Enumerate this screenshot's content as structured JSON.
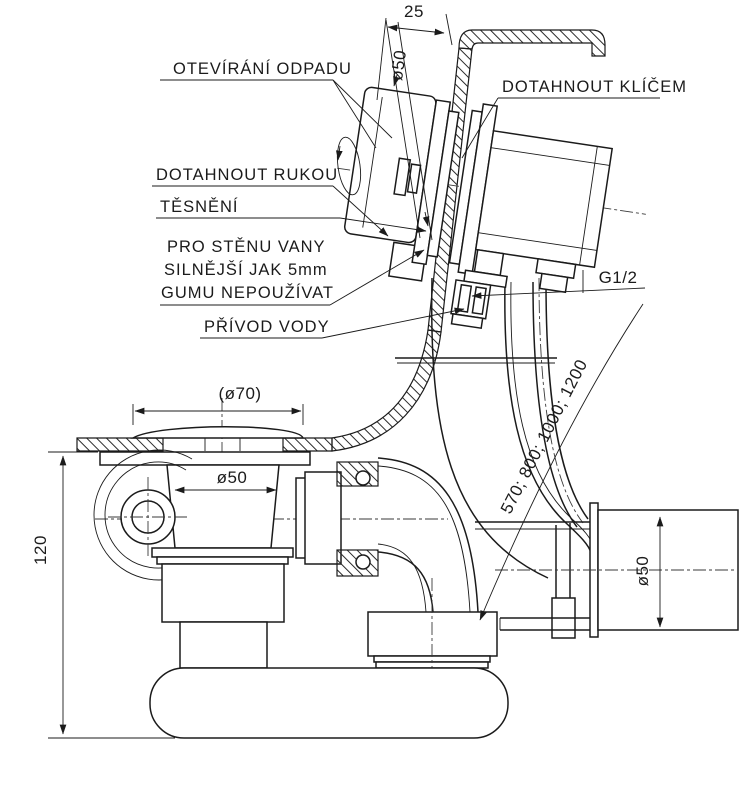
{
  "drawing": {
    "type": "technical drawing — bathtub waste, overflow and filling set, side section",
    "background": "#ffffff",
    "line_color": "#1b1b1b",
    "callouts": {
      "open_drain": "OTEVÍRÁNÍ ODPADU",
      "tighten_with_wrench": "DOTAHNOUT KLÍČEM",
      "tighten_by_hand": "DOTAHNOUT RUKOU",
      "seal": "TĚSNĚNÍ",
      "wall_note_line1": "PRO STĚNU VANY",
      "wall_note_line2": "SILNĚJŠÍ JAK 5mm",
      "wall_note_line3": "GUMU NEPOUŽÍVAT",
      "water_supply": "PŘÍVOD VODY"
    },
    "dimensions": {
      "wall_offset": "25",
      "overflow_diameter": "ø50",
      "supply_thread": "G1/2",
      "pipe_lengths": "570; 800; 1000; 1200",
      "cap_diameter": "(ø70)",
      "drain_diameter": "ø50",
      "outlet_diameter": "ø50",
      "trap_height": "120"
    }
  }
}
